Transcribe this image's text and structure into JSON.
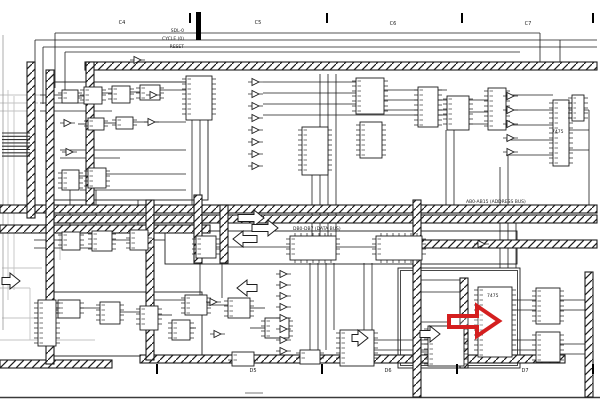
{
  "annotation": {
    "red_arrow": {
      "shape": "hollow-right-arrow",
      "points": "449,316 477,316 477,306 499,321 477,336 477,327 449,327",
      "color": "#d41f1f",
      "stroke_width": 4
    }
  },
  "zones": {
    "top_labels": [
      {
        "x": 122,
        "y": 24,
        "text": "C4"
      },
      {
        "x": 258,
        "y": 24,
        "text": "C5"
      },
      {
        "x": 393,
        "y": 25,
        "text": "C6"
      },
      {
        "x": 528,
        "y": 25,
        "text": "C7"
      }
    ],
    "top_ticks": [
      {
        "x": 190,
        "y": 13
      },
      {
        "x": 327,
        "y": 13
      },
      {
        "x": 462,
        "y": 13
      },
      {
        "x": 593,
        "y": 13
      }
    ],
    "bottom_labels": [
      {
        "x": 253,
        "y": 372,
        "text": "D5"
      },
      {
        "x": 388,
        "y": 372,
        "text": "D6"
      },
      {
        "x": 525,
        "y": 372,
        "text": "D7"
      }
    ],
    "bottom_ticks": [
      {
        "x": 157,
        "y": 364
      },
      {
        "x": 322,
        "y": 364
      },
      {
        "x": 457,
        "y": 364
      },
      {
        "x": 593,
        "y": 364
      }
    ]
  },
  "signal_labels": [
    {
      "x": 184,
      "y": 32,
      "text": "SDL-0",
      "anchor": "end"
    },
    {
      "x": 184,
      "y": 40,
      "text": "CYCLE (0)",
      "anchor": "end"
    },
    {
      "x": 184,
      "y": 48,
      "text": "RESET",
      "anchor": "end"
    },
    {
      "x": 466,
      "y": 203,
      "text": "AB0-AB15 (ADDRESS BUS)",
      "anchor": "start"
    },
    {
      "x": 293,
      "y": 230,
      "text": "DB0-DB7 (DATA BUS)",
      "anchor": "start"
    },
    {
      "x": 487,
      "y": 297,
      "text": "7475",
      "anchor": "start"
    },
    {
      "x": 552,
      "y": 133,
      "text": "7475",
      "anchor": "start"
    }
  ],
  "schematic": {
    "ink": "#1c1c1c",
    "ghost_color": "#c3c3c3",
    "buses_h": [
      {
        "x": 85,
        "y": 66,
        "len": 512
      },
      {
        "x": 0,
        "y": 209,
        "len": 597
      },
      {
        "x": 48,
        "y": 219,
        "len": 549
      },
      {
        "x": 0,
        "y": 229,
        "len": 210
      },
      {
        "x": 400,
        "y": 244,
        "len": 197
      },
      {
        "x": 140,
        "y": 359,
        "len": 425
      },
      {
        "x": 0,
        "y": 364,
        "len": 112
      }
    ],
    "buses_v": [
      {
        "x": 31,
        "y": 62,
        "len": 156
      },
      {
        "x": 50,
        "y": 70,
        "len": 294
      },
      {
        "x": 90,
        "y": 62,
        "len": 143
      },
      {
        "x": 150,
        "y": 200,
        "len": 160
      },
      {
        "x": 198,
        "y": 195,
        "len": 68
      },
      {
        "x": 224,
        "y": 205,
        "len": 58
      },
      {
        "x": 417,
        "y": 200,
        "len": 197
      },
      {
        "x": 464,
        "y": 278,
        "len": 90
      },
      {
        "x": 589,
        "y": 272,
        "len": 125
      }
    ],
    "solid_bars": [
      {
        "x": 196,
        "y": 12,
        "w": 5,
        "h": 28
      }
    ],
    "frames": [
      {
        "x": 54,
        "y": 82,
        "w": 154,
        "h": 118,
        "double": false
      },
      {
        "x": 54,
        "y": 292,
        "w": 148,
        "h": 64,
        "double": false
      },
      {
        "x": 165,
        "y": 231,
        "w": 352,
        "h": 33,
        "double": false
      },
      {
        "x": 398,
        "y": 268,
        "w": 122,
        "h": 100,
        "double": true
      }
    ],
    "blocks": [
      [
        62,
        90,
        16,
        13
      ],
      [
        84,
        87,
        18,
        17
      ],
      [
        112,
        86,
        18,
        17
      ],
      [
        140,
        85,
        20,
        15
      ],
      [
        186,
        76,
        26,
        44
      ],
      [
        88,
        118,
        16,
        12
      ],
      [
        116,
        117,
        17,
        12
      ],
      [
        62,
        170,
        17,
        20
      ],
      [
        88,
        168,
        18,
        20
      ],
      [
        62,
        232,
        18,
        18
      ],
      [
        92,
        231,
        20,
        20
      ],
      [
        130,
        230,
        18,
        20
      ],
      [
        58,
        300,
        22,
        18
      ],
      [
        100,
        302,
        20,
        22
      ],
      [
        140,
        306,
        18,
        24
      ],
      [
        172,
        320,
        18,
        20
      ],
      [
        38,
        300,
        18,
        46
      ],
      [
        302,
        127,
        26,
        48
      ],
      [
        356,
        78,
        28,
        36
      ],
      [
        360,
        122,
        22,
        36
      ],
      [
        447,
        96,
        22,
        34
      ],
      [
        488,
        88,
        18,
        42
      ],
      [
        418,
        87,
        20,
        40
      ],
      [
        553,
        100,
        16,
        66
      ],
      [
        572,
        95,
        12,
        26
      ],
      [
        196,
        236,
        20,
        22
      ],
      [
        290,
        236,
        46,
        24
      ],
      [
        376,
        236,
        46,
        24
      ],
      [
        185,
        295,
        22,
        20
      ],
      [
        228,
        298,
        22,
        20
      ],
      [
        265,
        318,
        24,
        20
      ],
      [
        232,
        352,
        22,
        14
      ],
      [
        300,
        350,
        20,
        14
      ],
      [
        428,
        326,
        36,
        40
      ],
      [
        340,
        330,
        34,
        36
      ],
      [
        478,
        287,
        34,
        70
      ],
      [
        536,
        288,
        24,
        36
      ],
      [
        536,
        332,
        24,
        30
      ]
    ],
    "gates": [
      [
        64,
        123,
        1
      ],
      [
        66,
        152,
        1
      ],
      [
        150,
        95,
        1
      ],
      [
        148,
        122,
        1
      ],
      [
        134,
        60,
        1
      ],
      [
        252,
        82,
        1
      ],
      [
        252,
        94,
        1
      ],
      [
        252,
        106,
        1
      ],
      [
        252,
        118,
        1
      ],
      [
        252,
        130,
        1
      ],
      [
        252,
        142,
        1
      ],
      [
        252,
        154,
        1
      ],
      [
        252,
        166,
        1
      ],
      [
        478,
        244,
        1
      ],
      [
        280,
        274,
        1
      ],
      [
        280,
        285,
        1
      ],
      [
        280,
        296,
        1
      ],
      [
        280,
        307,
        1
      ],
      [
        280,
        318,
        1
      ],
      [
        280,
        329,
        1
      ],
      [
        280,
        340,
        1
      ],
      [
        280,
        351,
        1
      ],
      [
        507,
        96,
        1
      ],
      [
        507,
        110,
        1
      ],
      [
        507,
        124,
        1
      ],
      [
        507,
        138,
        1
      ],
      [
        507,
        152,
        1
      ],
      [
        210,
        302,
        1
      ],
      [
        214,
        334,
        1
      ]
    ],
    "hollow_arrows": [
      {
        "tx": 264,
        "ty": 218,
        "dir": 1,
        "len": 26
      },
      {
        "tx": 278,
        "ty": 228,
        "dir": 1,
        "len": 26
      },
      {
        "tx": 233,
        "ty": 239,
        "dir": -1,
        "len": 24
      },
      {
        "tx": 237,
        "ty": 288,
        "dir": -1,
        "len": 20
      },
      {
        "tx": 20,
        "ty": 281,
        "dir": 1,
        "len": 18
      },
      {
        "tx": 440,
        "ty": 334,
        "dir": 1,
        "len": 20
      },
      {
        "tx": 368,
        "ty": 338,
        "dir": 1,
        "len": 16
      }
    ],
    "wires": [
      [
        55,
        33,
        540,
        33
      ],
      [
        35,
        40,
        597,
        40
      ],
      [
        43,
        47,
        597,
        47
      ],
      [
        65,
        52,
        520,
        52
      ],
      [
        55,
        33,
        55,
        88
      ],
      [
        35,
        40,
        35,
        96
      ],
      [
        43,
        47,
        43,
        104
      ],
      [
        65,
        52,
        65,
        90
      ],
      [
        40,
        95,
        62,
        95
      ],
      [
        40,
        103,
        84,
        103
      ],
      [
        40,
        111,
        112,
        111
      ],
      [
        78,
        96,
        84,
        96
      ],
      [
        102,
        93,
        112,
        93
      ],
      [
        130,
        92,
        140,
        92
      ],
      [
        160,
        90,
        186,
        90
      ],
      [
        78,
        124,
        88,
        124
      ],
      [
        104,
        123,
        116,
        123
      ],
      [
        133,
        122,
        186,
        122
      ],
      [
        60,
        150,
        186,
        150
      ],
      [
        60,
        158,
        120,
        158
      ],
      [
        64,
        176,
        88,
        176
      ],
      [
        106,
        174,
        186,
        174
      ],
      [
        80,
        190,
        186,
        190
      ],
      [
        192,
        120,
        192,
        231
      ],
      [
        200,
        120,
        200,
        195
      ],
      [
        70,
        188,
        70,
        232
      ],
      [
        96,
        190,
        96,
        231
      ],
      [
        138,
        200,
        138,
        230
      ],
      [
        34,
        240,
        62,
        240
      ],
      [
        34,
        248,
        92,
        248
      ],
      [
        112,
        240,
        130,
        240
      ],
      [
        150,
        240,
        165,
        240
      ],
      [
        40,
        310,
        58,
        310
      ],
      [
        80,
        308,
        100,
        308
      ],
      [
        120,
        312,
        140,
        312
      ],
      [
        158,
        315,
        172,
        315
      ],
      [
        190,
        328,
        196,
        328
      ],
      [
        320,
        74,
        320,
        236
      ],
      [
        328,
        74,
        328,
        236
      ],
      [
        336,
        74,
        336,
        236
      ],
      [
        312,
        130,
        312,
        236
      ],
      [
        263,
        82,
        356,
        82
      ],
      [
        263,
        93,
        356,
        93
      ],
      [
        263,
        104,
        356,
        104
      ],
      [
        263,
        115,
        447,
        115
      ],
      [
        384,
        90,
        447,
        90
      ],
      [
        384,
        100,
        447,
        100
      ],
      [
        384,
        110,
        447,
        110
      ],
      [
        469,
        100,
        488,
        100
      ],
      [
        469,
        112,
        488,
        112
      ],
      [
        469,
        124,
        488,
        124
      ],
      [
        506,
        95,
        553,
        95
      ],
      [
        506,
        110,
        553,
        110
      ],
      [
        506,
        125,
        553,
        125
      ],
      [
        506,
        140,
        553,
        140
      ],
      [
        506,
        155,
        553,
        155
      ],
      [
        569,
        110,
        589,
        110
      ],
      [
        569,
        130,
        589,
        130
      ],
      [
        569,
        150,
        589,
        150
      ],
      [
        589,
        110,
        589,
        205
      ],
      [
        500,
        167,
        500,
        205
      ],
      [
        508,
        150,
        508,
        205
      ],
      [
        446,
        130,
        446,
        205
      ],
      [
        454,
        130,
        454,
        205
      ],
      [
        216,
        247,
        290,
        247
      ],
      [
        336,
        247,
        376,
        247
      ],
      [
        422,
        244,
        472,
        244
      ],
      [
        484,
        244,
        517,
        244
      ],
      [
        150,
        300,
        185,
        300
      ],
      [
        207,
        305,
        228,
        305
      ],
      [
        250,
        308,
        265,
        308
      ],
      [
        250,
        328,
        265,
        328
      ],
      [
        310,
        263,
        310,
        350
      ],
      [
        318,
        263,
        318,
        350
      ],
      [
        326,
        263,
        326,
        350
      ],
      [
        334,
        263,
        334,
        330
      ],
      [
        364,
        263,
        364,
        330
      ],
      [
        372,
        263,
        372,
        330
      ],
      [
        374,
        340,
        428,
        340
      ],
      [
        374,
        350,
        428,
        350
      ],
      [
        419,
        280,
        464,
        280
      ],
      [
        419,
        292,
        464,
        292
      ],
      [
        419,
        344,
        464,
        344
      ],
      [
        419,
        352,
        464,
        352
      ],
      [
        421,
        322,
        449,
        322
      ],
      [
        512,
        300,
        536,
        300
      ],
      [
        512,
        310,
        536,
        310
      ],
      [
        512,
        340,
        536,
        340
      ],
      [
        512,
        350,
        536,
        350
      ],
      [
        560,
        300,
        589,
        300
      ],
      [
        560,
        310,
        589,
        310
      ],
      [
        560,
        344,
        589,
        344
      ],
      [
        560,
        354,
        589,
        354
      ],
      [
        500,
        223,
        500,
        268
      ],
      [
        508,
        223,
        508,
        268
      ],
      [
        516,
        223,
        516,
        268
      ],
      [
        222,
        263,
        222,
        298
      ],
      [
        200,
        263,
        200,
        295
      ],
      [
        540,
        33,
        540,
        62
      ],
      [
        560,
        40,
        560,
        66
      ]
    ],
    "ghost_lines": [
      [
        0,
        95,
        40,
        95
      ],
      [
        0,
        103,
        38,
        103
      ],
      [
        0,
        111,
        36,
        111
      ],
      [
        8,
        90,
        8,
        300
      ],
      [
        14,
        96,
        14,
        290
      ],
      [
        0,
        225,
        60,
        225
      ],
      [
        0,
        233,
        58,
        233
      ],
      [
        60,
        225,
        60,
        260
      ],
      [
        0,
        288,
        30,
        288
      ],
      [
        30,
        288,
        30,
        340
      ],
      [
        0,
        340,
        95,
        340
      ],
      [
        2,
        268,
        42,
        268
      ],
      [
        2,
        318,
        42,
        318
      ]
    ],
    "tag_stacks": [
      {
        "x": 2,
        "y": 133,
        "w": 28,
        "n": 8,
        "gap": 3.3
      }
    ],
    "page_marks": {
      "bottom_border_y": 397.5,
      "left_border": {
        "x": 3,
        "y1": 35,
        "y2": 330
      },
      "center_dash": {
        "x1": 245,
        "x2": 263,
        "y": 393
      }
    }
  }
}
